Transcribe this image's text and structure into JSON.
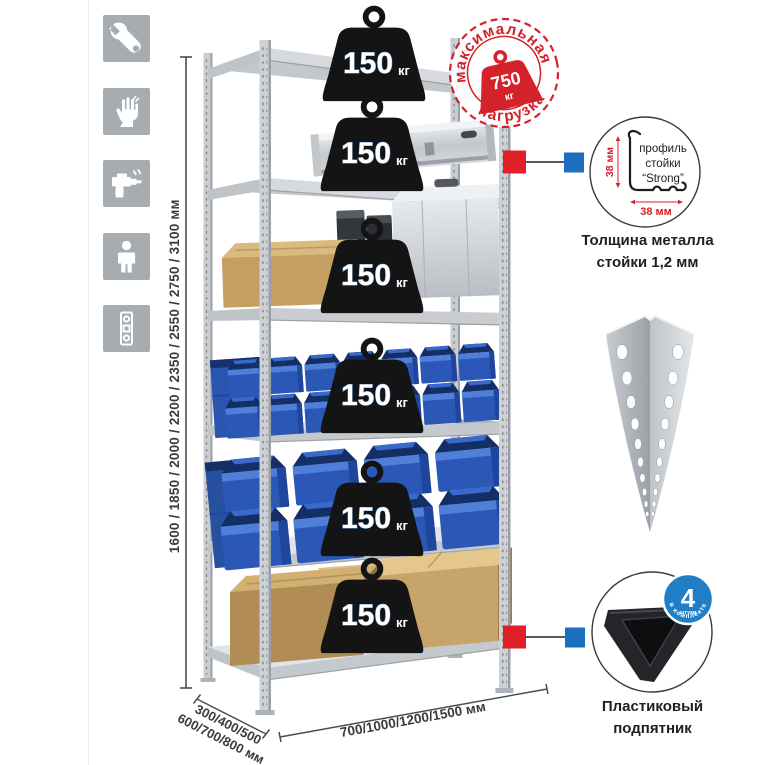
{
  "sidebar": {
    "icons": [
      {
        "name": "wrench"
      },
      {
        "name": "gloves"
      },
      {
        "name": "drill"
      },
      {
        "name": "person"
      },
      {
        "name": "level"
      }
    ]
  },
  "dimensions": {
    "height": "1600 / 1850 / 2000 / 2200 / 2350 / 2550 / 2750 / 3100 мм",
    "depth_line1": "300/400/500",
    "depth_line2": "600/700/800 мм",
    "width": "700/1000/1200/1500 мм"
  },
  "max_load_stamp": {
    "arc_top": "максимальная",
    "arc_bottom": "нагрузка",
    "value": "750",
    "unit": "кг"
  },
  "rack": {
    "badges": [
      {
        "value": "150",
        "unit": "кг"
      },
      {
        "value": "150",
        "unit": "кг"
      },
      {
        "value": "150",
        "unit": "кг"
      },
      {
        "value": "150",
        "unit": "кг"
      },
      {
        "value": "150",
        "unit": "кг"
      },
      {
        "value": "150",
        "unit": "кг"
      }
    ]
  },
  "profile_detail": {
    "dim_vertical": "38 мм",
    "dim_horizontal": "38 мм",
    "label_line1": "профиль",
    "label_line2": "стойки",
    "label_line3": "“Strong”",
    "caption_line1": "Толщина металла",
    "caption_line2": "стойки 1,2 мм"
  },
  "foot_detail": {
    "badge_value": "4",
    "badge_sub": "штуки",
    "badge_arc": "в комплекте",
    "caption_line1": "Пластиковый",
    "caption_line2": "подпятник"
  },
  "colors": {
    "accent_red": "#d4212a",
    "connector_red": "#e01f26",
    "connector_blue": "#1b6fbe",
    "foot_badge_blue": "#1f7ec6",
    "bin_blue": "#2b58b6",
    "metal_gray": "#c9cdd1",
    "icon_gray": "#a7acb1",
    "weight_black": "#141414"
  }
}
